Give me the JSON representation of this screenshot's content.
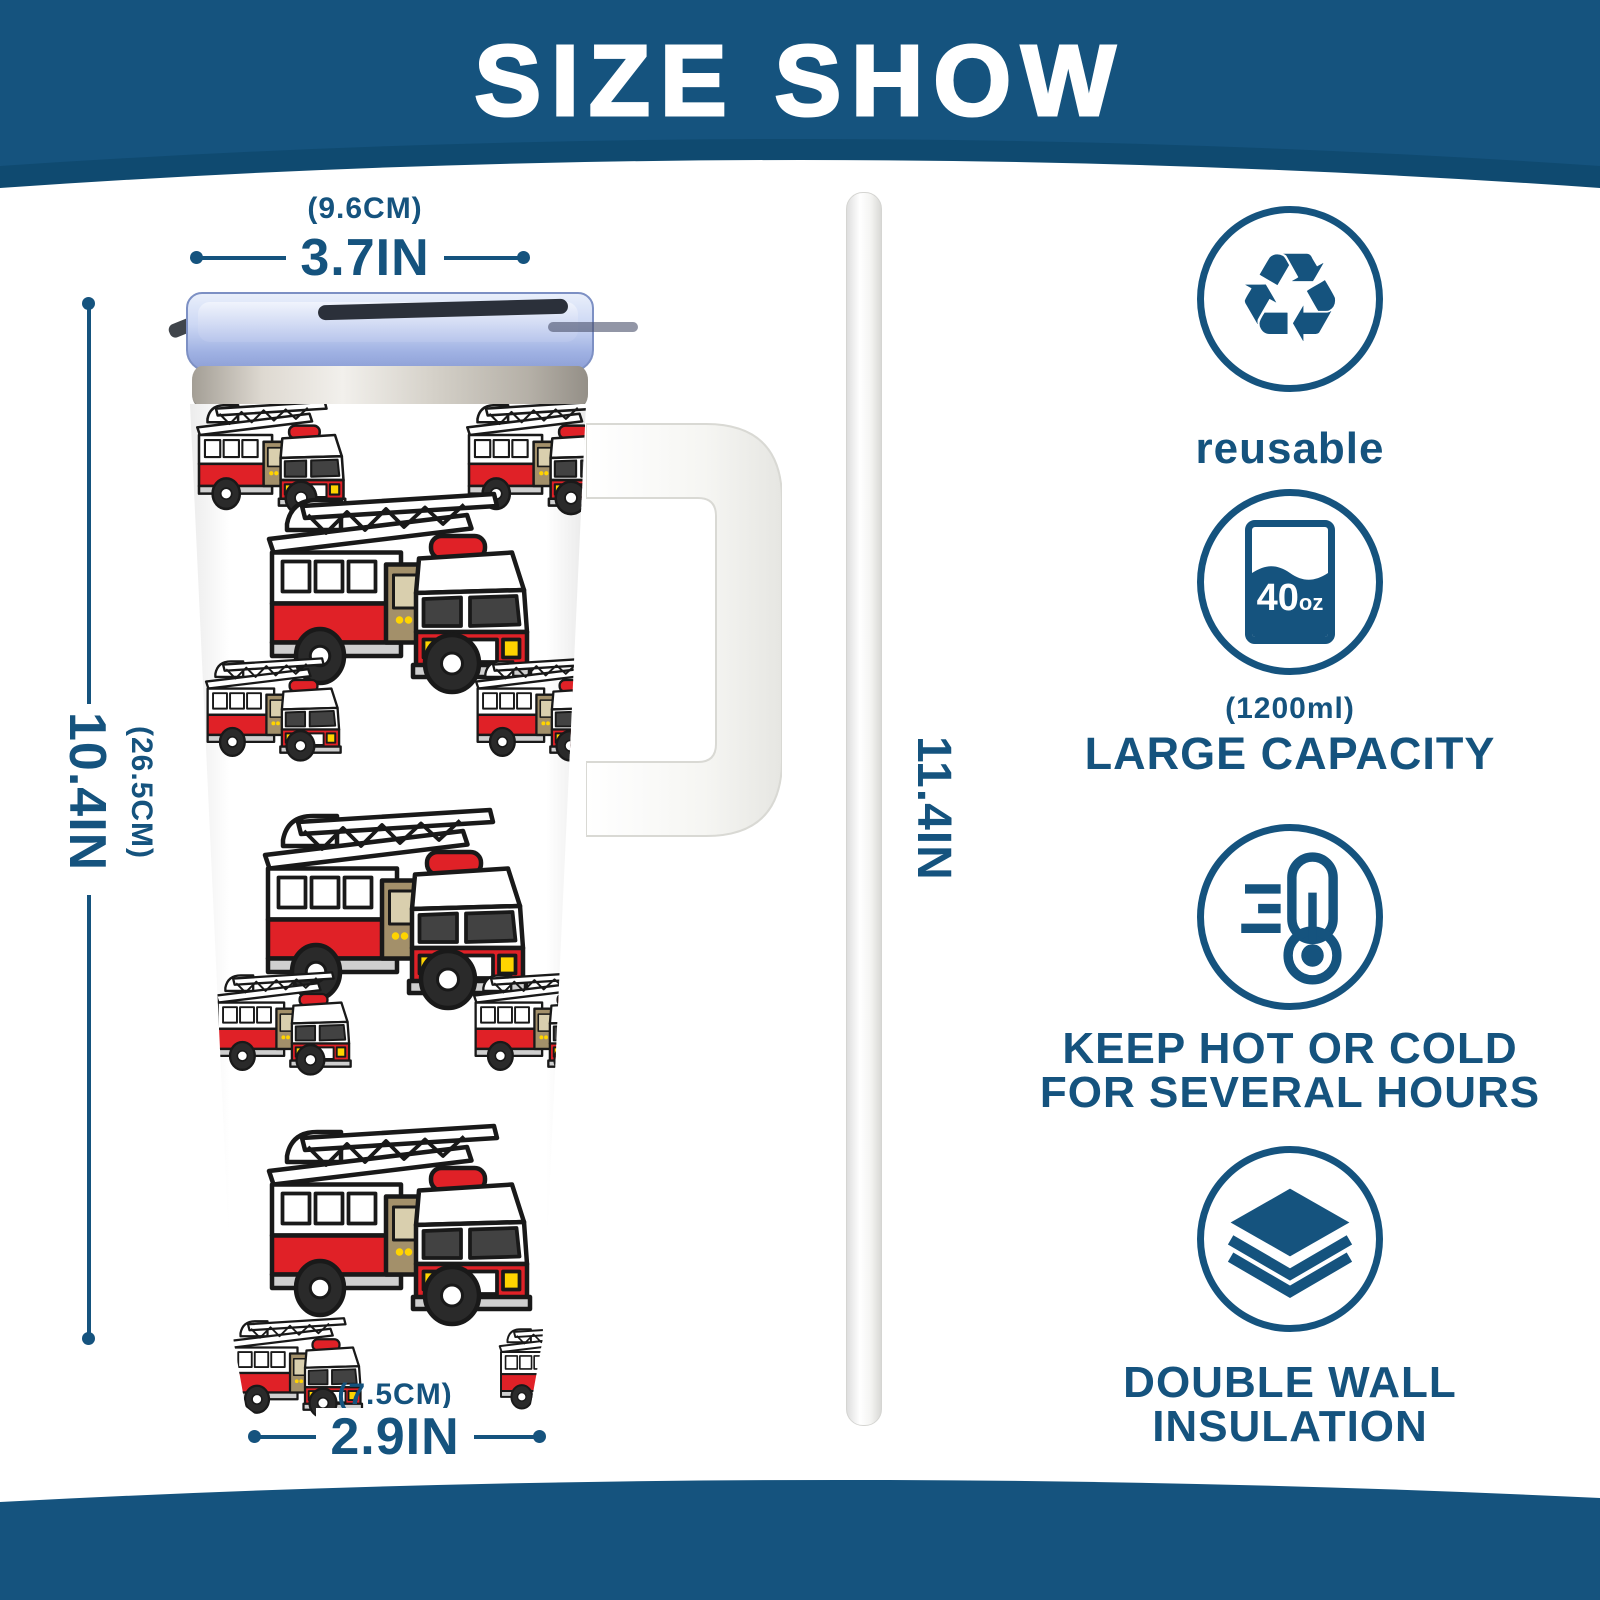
{
  "header": {
    "title": "SIZE SHOW"
  },
  "dimensions": {
    "top_cm": "(9.6CM)",
    "top_in": "3.7IN",
    "height_cm": "(26.5CM)",
    "height_in": "10.4IN",
    "bottom_cm": "(7.5CM)",
    "bottom_in": "2.9IN",
    "straw_in": "11.4IN"
  },
  "features": [
    {
      "label": "reusable"
    },
    {
      "badge_value": "40",
      "badge_unit": "oz",
      "sub_label": "(1200ml)",
      "label": "LARGE CAPACITY"
    },
    {
      "label_line1": "KEEP HOT OR COLD",
      "label_line2": "FOR SEVERAL HOURS"
    },
    {
      "label_line1": "DOUBLE WALL",
      "label_line2": "INSULATION"
    }
  ],
  "icons": {
    "recycle_glyph": "♻"
  },
  "colors": {
    "primary_blue": "#15537e",
    "header_underlay": "#0f4a70",
    "truck_red": "#e02127",
    "truck_yellow": "#ffd400",
    "lid_blue": "#b9c6ec",
    "steel_silver": "#d8d4cc",
    "handle_white": "#f7f7f4"
  }
}
